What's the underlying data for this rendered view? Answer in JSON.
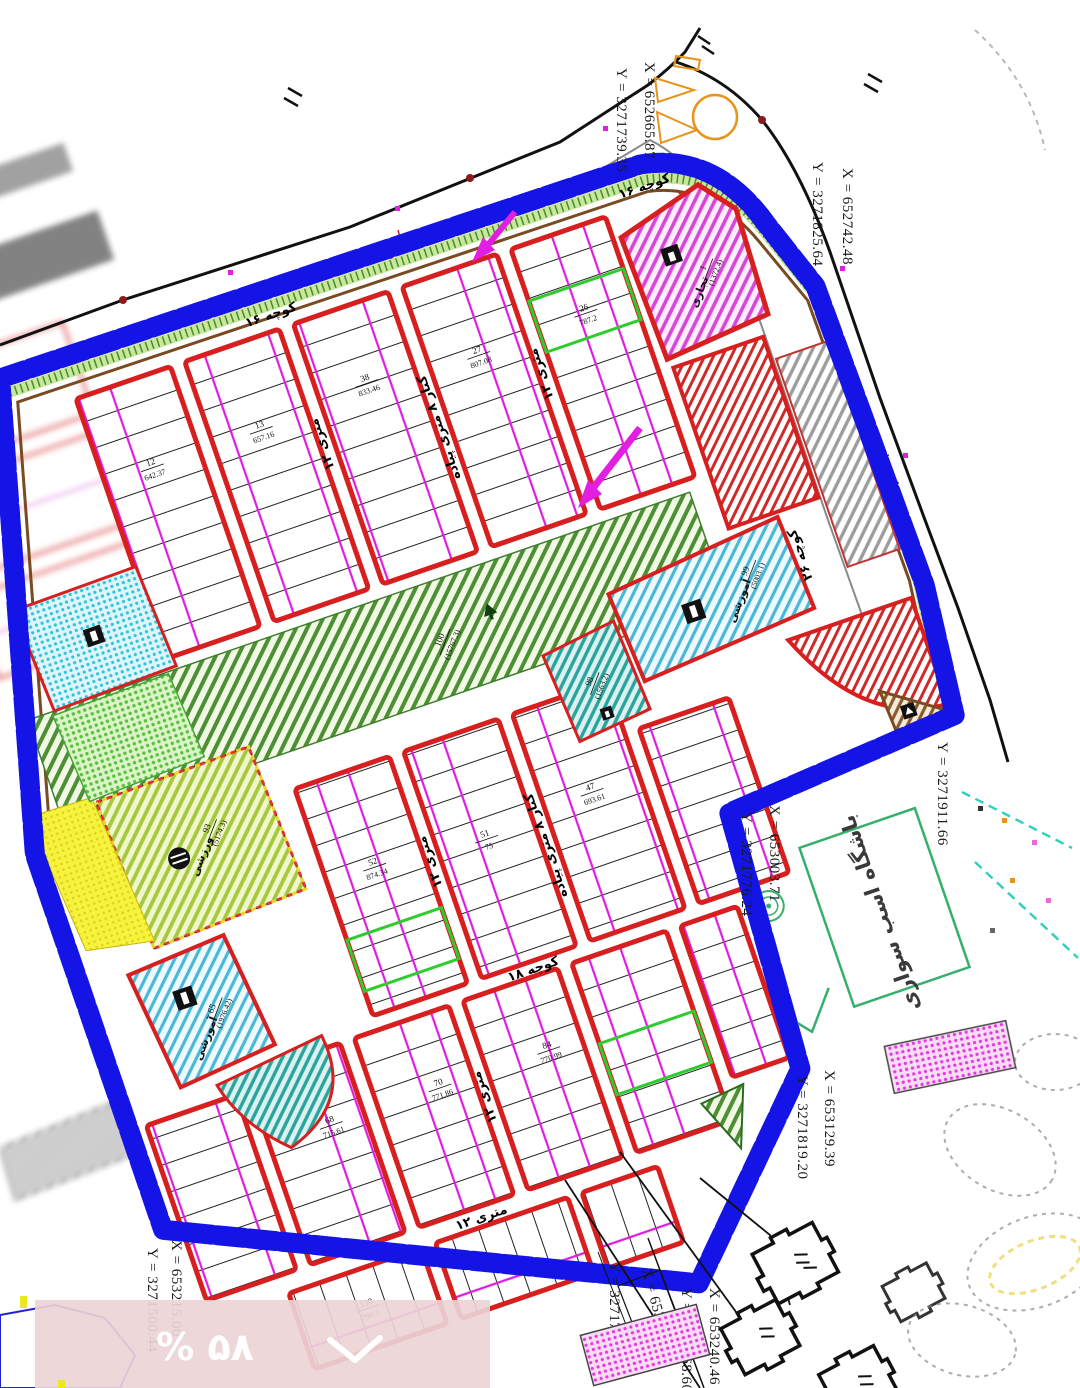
{
  "overlay": {
    "percent": "% ۵۸"
  },
  "coords": {
    "c1x": "X = 652665.87",
    "c1y": "Y = 3271739.35",
    "c2x": "X = 652742.48",
    "c2y": "Y = 3271825.64",
    "c3x": "X = 653003.71",
    "c3y": "Y = 3271776.24",
    "c4y": "Y = 3271911.66",
    "c5x": "X = 653129.39",
    "c5y": "Y = 3271819.20",
    "c6x": "X = 653215.00",
    "c6y": "Y = 3271500.44",
    "c7x": "X = 653229.24",
    "c7y": "Y = 3271740.35",
    "c8x": "X = 653240.46",
    "c8y": "Y = 3271768.60"
  },
  "zones": {
    "park": {
      "num": "100",
      "area": "(15767.3)"
    },
    "edu99": {
      "num": "99",
      "name": "آموزشی",
      "area": "(5003.1)"
    },
    "sport98": {
      "num": "98",
      "name": "ورزشی",
      "area": "(1563.2)"
    },
    "sport93": {
      "num": "93",
      "name": "ورزشی",
      "area": "(5174.3)"
    },
    "edu65": {
      "num": "65",
      "name": "آموزشی",
      "area": "(1976.42)"
    },
    "com1": {
      "num": "1",
      "name": "تجاری",
      "area": "(1372.4)"
    },
    "horse_club": "باشگاه اسب سواری"
  },
  "streets": {
    "k16": "کوچه ۱۶",
    "k18": "کوچه ۱۸",
    "k26": "کوچه ۲۶",
    "m12": "۱۲ متری",
    "walk8": "کنار ۸ متری پیاده",
    "road_note": "میله سواره"
  },
  "lots": [
    {
      "num": "12",
      "area": "642.37"
    },
    {
      "num": "13",
      "area": "657.16"
    },
    {
      "num": "38",
      "area": "833.46"
    },
    {
      "num": "27",
      "area": "807.08"
    },
    {
      "num": "26",
      "area": "787.2"
    },
    {
      "num": "52",
      "area": "874.34"
    },
    {
      "num": "51",
      "area": "75"
    },
    {
      "num": "47",
      "area": "693.61"
    },
    {
      "num": "68",
      "area": "715.61"
    },
    {
      "num": "70",
      "area": "771.86"
    },
    {
      "num": "84",
      "area": "770.99"
    },
    {
      "num": "130",
      "area": "798.3"
    }
  ]
}
